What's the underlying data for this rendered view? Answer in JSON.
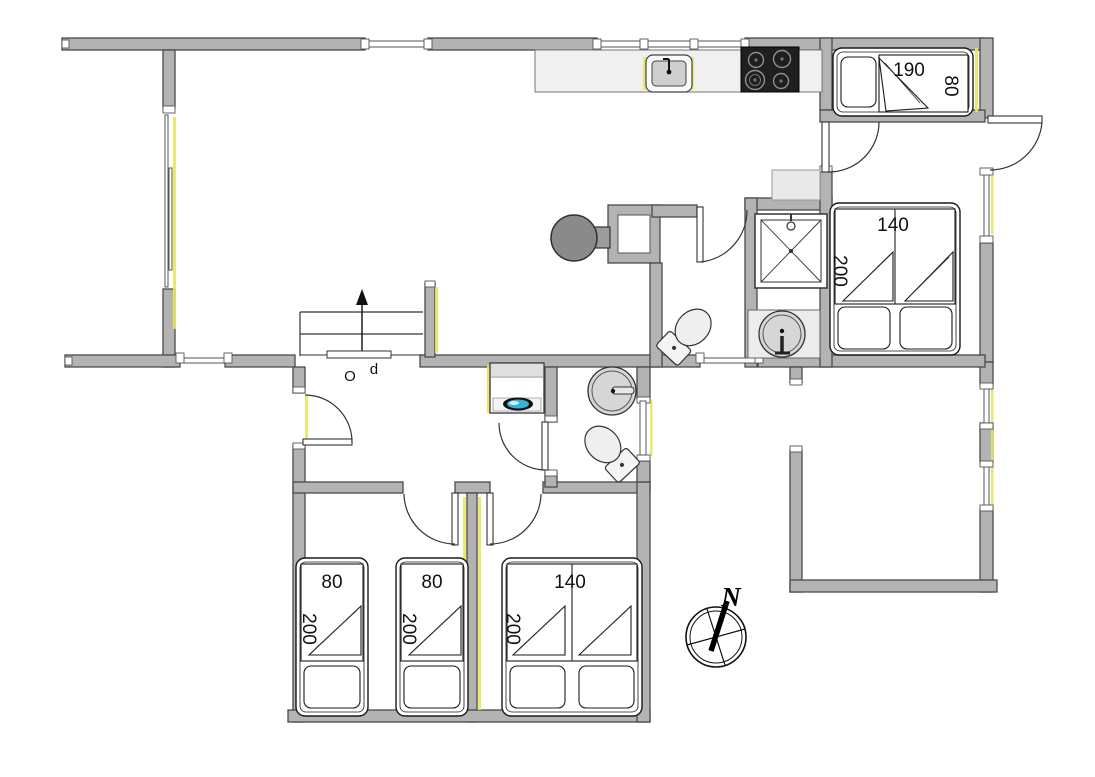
{
  "plan": {
    "beds": {
      "top_right_single": {
        "length": "190",
        "width": "80"
      },
      "right_double": {
        "width": "140",
        "length": "200"
      },
      "bottom_single_left": {
        "width": "80",
        "length": "200"
      },
      "bottom_single_mid": {
        "width": "80",
        "length": "200"
      },
      "bottom_double": {
        "width": "140",
        "length": "200"
      }
    },
    "stairs": {
      "label": "Op",
      "letter_o": "O",
      "letter_p": "p"
    },
    "compass": {
      "north": "N"
    },
    "colors": {
      "wall_fill": "#b3b3b3",
      "wall_stroke": "#4a4a4a",
      "fixture_light": "#ececec",
      "basin_gray": "#d6d6d6",
      "stove_black": "#1f1f1f",
      "wood_stove_gray": "#8a8a8a",
      "accent_yellow": "#e9e463",
      "washer_teal": "#35b2d4",
      "line_dark": "#1a1a1a"
    }
  }
}
